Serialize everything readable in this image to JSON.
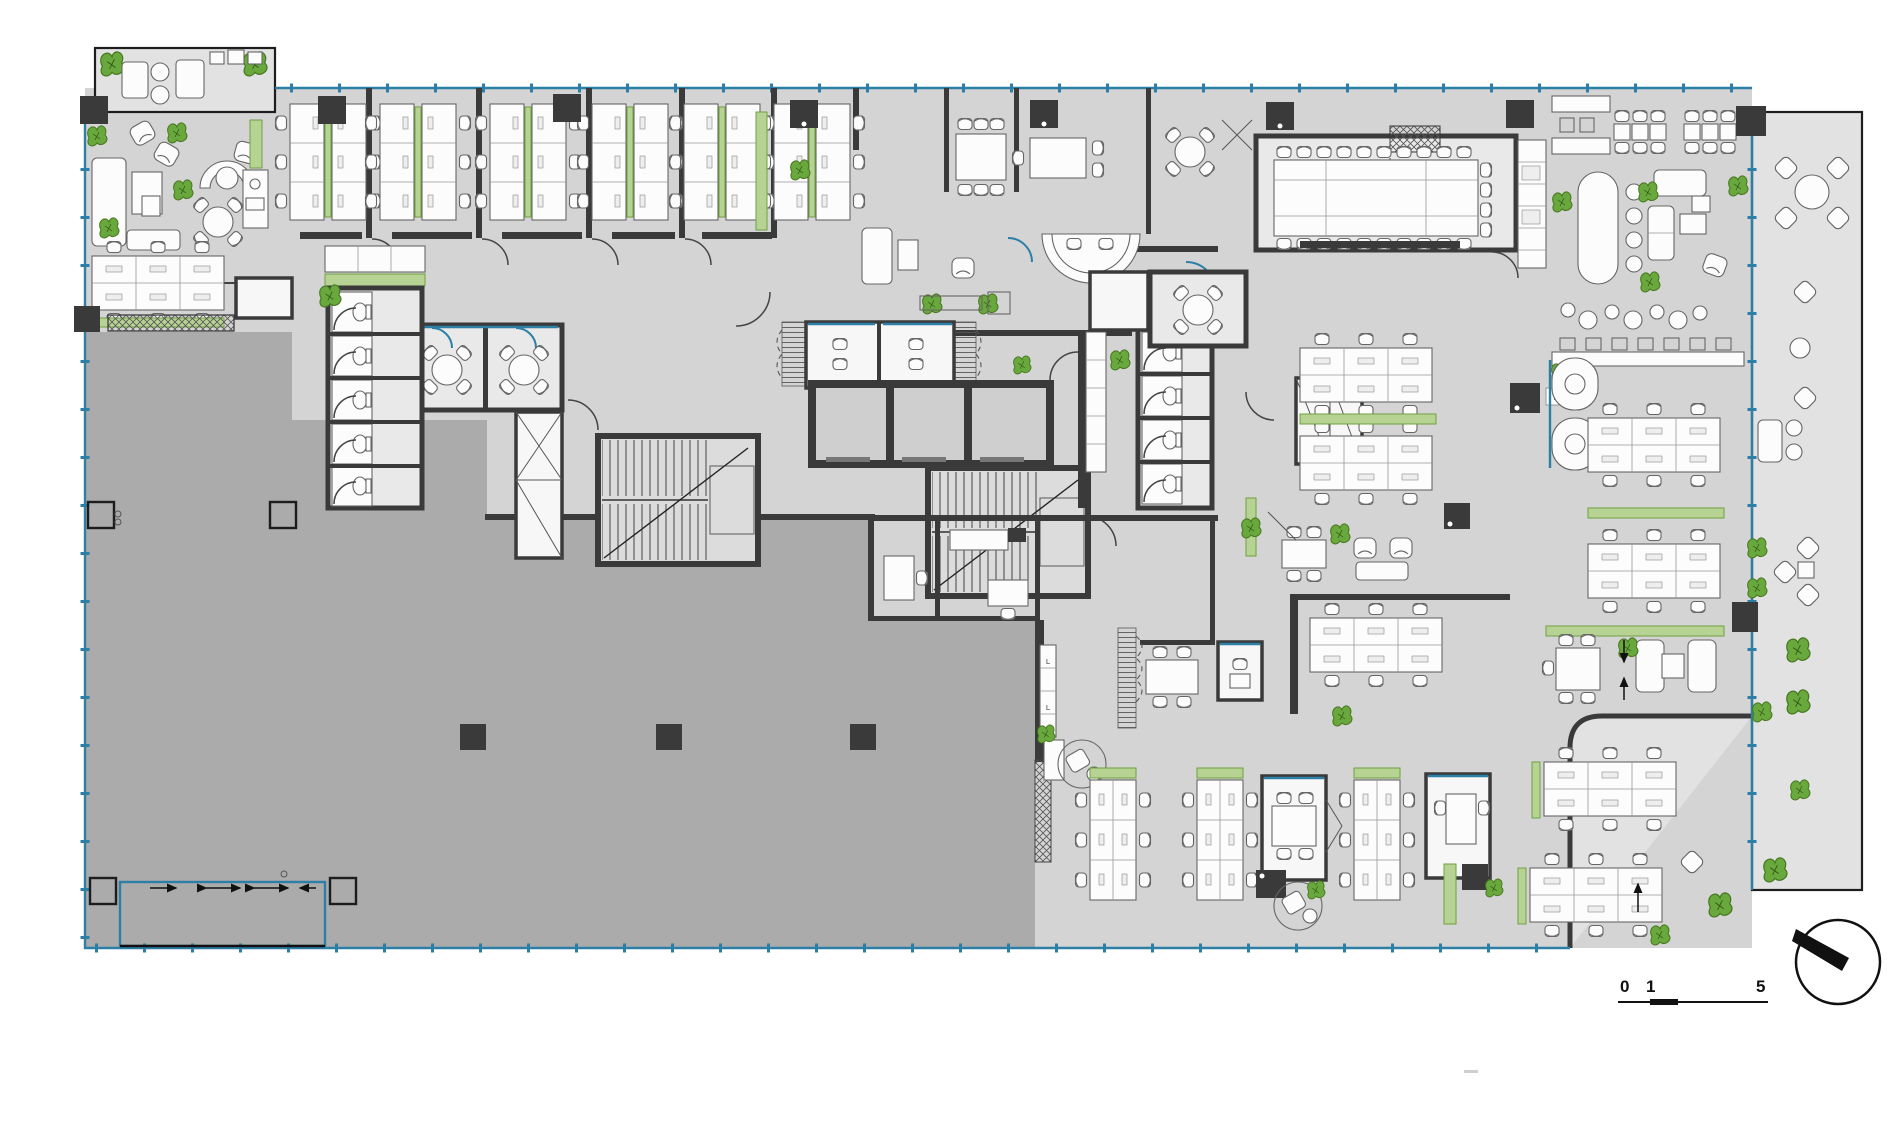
{
  "plan": {
    "labels": {
      "metal": "METAL",
      "locker": "L"
    },
    "scale_bar": {
      "t0": "0",
      "t1": "1",
      "t2": "5"
    },
    "colors": {
      "paper": "#ffffff",
      "floor": "#d4d4d4",
      "shell_space": "#ababab",
      "terrace": "#e2e2e2",
      "wall": "#3a3a3a",
      "glazing": "#2d7fa6",
      "plant": "#69a83d",
      "planter": "#b7d394",
      "furniture_fill": "#fcfcfc",
      "furniture_stroke": "#666666"
    },
    "icons": {
      "north_indicator": "compass-circle-with-needle",
      "scale_bar": "graphic-scale-0-1-5",
      "entrance_arrows": "direction-arrows",
      "stairs": "stair-treads",
      "elevators": "three-cell-elevator-bank",
      "plants": "leaf-cluster"
    }
  }
}
